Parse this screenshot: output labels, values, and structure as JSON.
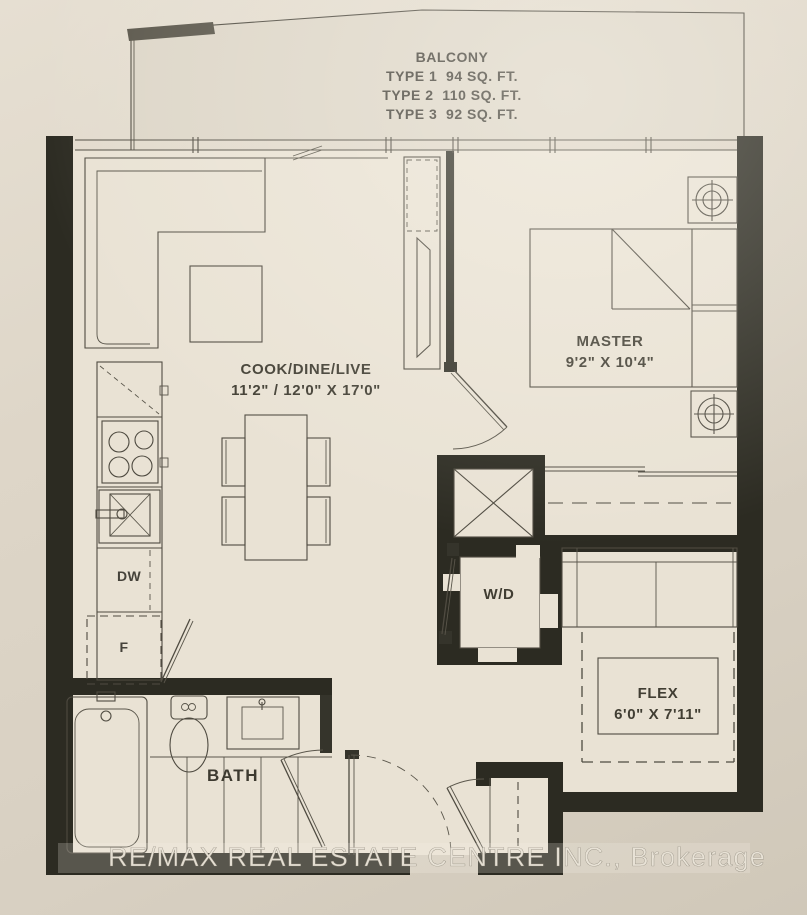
{
  "balcony": {
    "title": "BALCONY",
    "type1": "TYPE 1  94 SQ. FT.",
    "type2": "TYPE 2  110 SQ. FT.",
    "type3": "TYPE 3  92 SQ. FT."
  },
  "rooms": {
    "living": {
      "name": "COOK/DINE/LIVE",
      "dims": "11'2\" / 12'0\" X 17'0\""
    },
    "master": {
      "name": "MASTER",
      "dims": "9'2\" X 10'4\""
    },
    "flex": {
      "name": "FLEX",
      "dims": "6'0\" X 7'11\""
    },
    "bath": {
      "name": "BATH"
    },
    "laundry": {
      "name": "W/D"
    }
  },
  "appliances": {
    "dishwasher": "DW",
    "fridge": "F"
  },
  "watermark": "RE/MAX REAL ESTATE CENTRE INC., Brokerage",
  "colors": {
    "wall": "#2c2b22",
    "line": "#4f4b41",
    "floor": "#e9e2d4",
    "paper": "#dcd4c6",
    "watermark_text": "#e9e3d7"
  }
}
